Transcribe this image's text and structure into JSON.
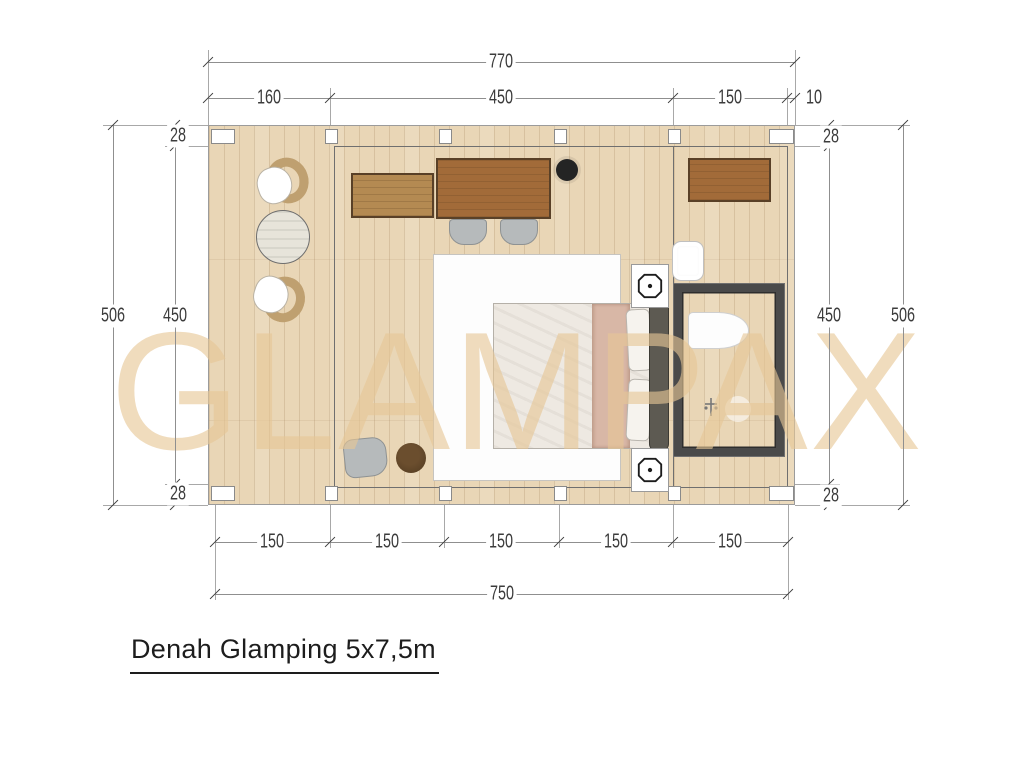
{
  "title": {
    "text": "Denah Glamping 5x7,5m"
  },
  "watermark": {
    "text": "GLAMPAX"
  },
  "dimensions": {
    "top": {
      "total": "770",
      "segments": [
        "160",
        "450",
        "150",
        "10"
      ]
    },
    "bottom": {
      "total": "750",
      "segments": [
        "150",
        "150",
        "150",
        "150",
        "150"
      ]
    },
    "left": {
      "outer": "506",
      "inner": "450",
      "wall_top": "28",
      "wall_bottom": "28"
    },
    "right": {
      "outer": "506",
      "inner": "450",
      "wall_top": "28",
      "wall_bottom": "28"
    }
  },
  "plan": {
    "furniture": [
      "terrace chair",
      "round table",
      "terrace chair",
      "credenza",
      "desk",
      "desk chair",
      "desk chair",
      "stove",
      "rug",
      "double bed",
      "pillows",
      "nightstand",
      "nightstand",
      "lounge chair",
      "pouf",
      "wardrobe",
      "sink",
      "bathroom",
      "toilet",
      "shower"
    ]
  },
  "colors": {
    "floor": "#e9d6b6",
    "wood-dark": "#a26b39",
    "wood-mid": "#b48a52",
    "wall": "#4a4a4a",
    "watermark": "#e7c796",
    "line": "#8f8f8f",
    "ink": "#3c3c3c"
  }
}
